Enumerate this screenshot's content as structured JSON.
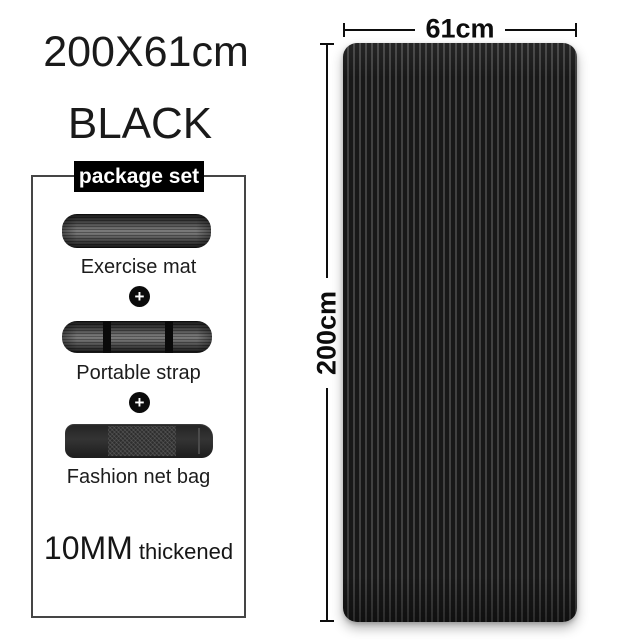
{
  "product": {
    "size_title": "200X61cm",
    "color_name": "BLACK",
    "thickness_value": "10MM",
    "thickness_suffix": " thickened"
  },
  "package": {
    "label": "package set",
    "plus": "+",
    "items": [
      {
        "label": "Exercise mat"
      },
      {
        "label": "Portable strap"
      },
      {
        "label": "Fashion net bag"
      }
    ]
  },
  "dimensions": {
    "width": "61cm",
    "height": "200cm"
  },
  "colors": {
    "background": "#ffffff",
    "text": "#1a1a1a",
    "mat_base": "#181818",
    "mat_stripe": "#414141",
    "package_label_bg": "#000000",
    "package_label_text": "#ffffff",
    "dimension_line": "#0d0d0d"
  }
}
